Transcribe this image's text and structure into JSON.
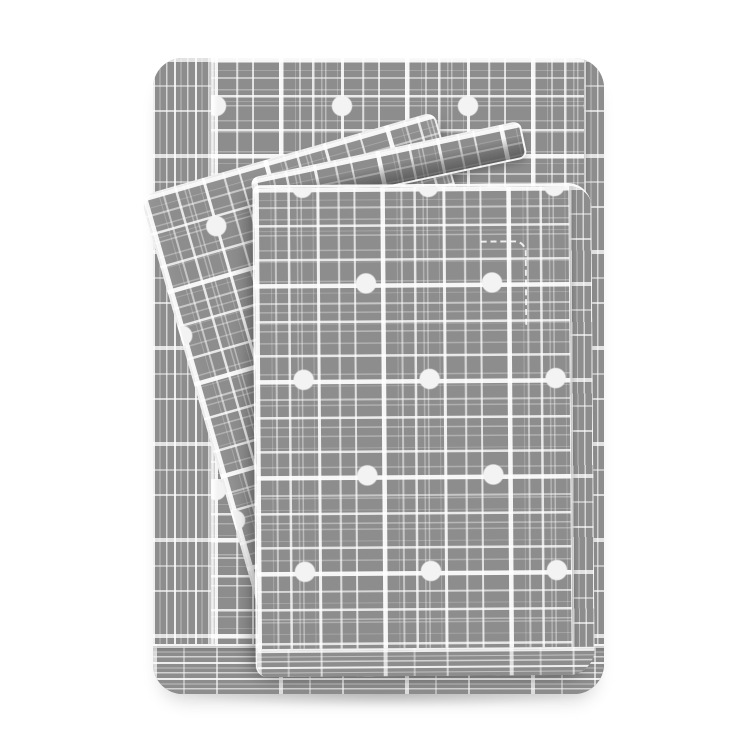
{
  "image_type": "product-photo",
  "scene": {
    "description": "Folded gray bed sheet set with a white crosshatch plaid pattern and scattered white polka dots, stacked with matching pillowcases, photographed on a plain white background",
    "background_color": "#ffffff"
  },
  "product": {
    "kind": "bed-sheet-set",
    "pattern": "white crosshatch plaid with white polka dots",
    "fabric_color": "#8d8d8d",
    "pattern_line_color": "#f5f5f5",
    "dot_color": "#f3f3f3",
    "fold_shadow_color": "#6f6f6f",
    "pieces": [
      {
        "id": "back-folded-sheet",
        "label": "Folded flat sheet at the back of the stack"
      },
      {
        "id": "pillowcase-left",
        "label": "Pillowcase draped diagonally on the left"
      },
      {
        "id": "pillowcase-flap",
        "label": "Pillowcase flap strip folded across the top"
      },
      {
        "id": "front-folded-sheet",
        "label": "Folded top sheet at the front of the stack"
      },
      {
        "id": "stitch-dashes",
        "label": "Dashed hem stitching detail on the front sheet"
      },
      {
        "id": "ground-shadow",
        "label": "Soft shadow beneath the stack"
      }
    ]
  }
}
